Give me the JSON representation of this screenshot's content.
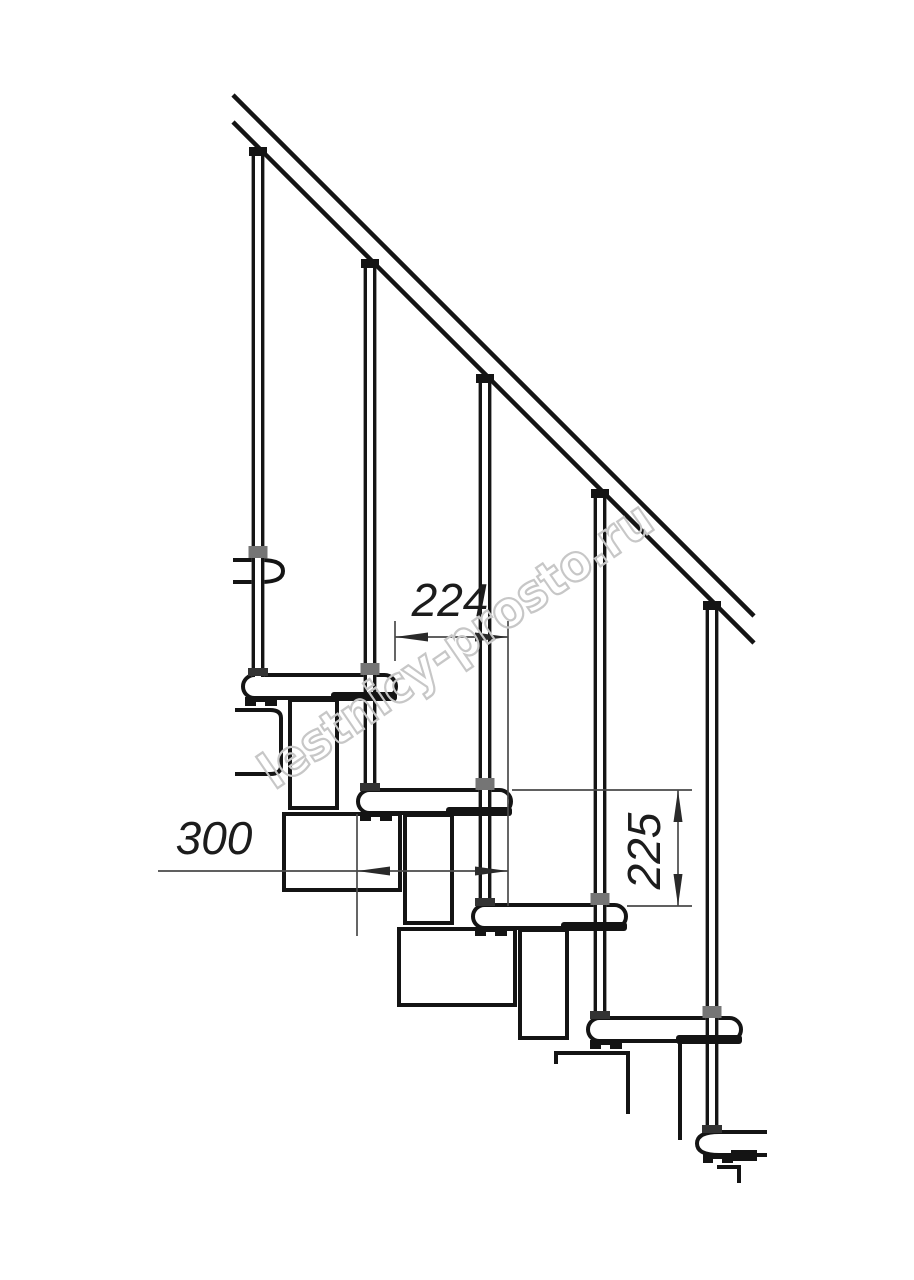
{
  "dimensions": {
    "run": {
      "value": "224"
    },
    "depth": {
      "value": "300"
    },
    "rise": {
      "value": "225"
    }
  },
  "watermark": {
    "text": "lestnicy-prosto.ru"
  },
  "colors": {
    "line": "#141414",
    "dimension": "#4a4a4a",
    "dimension_arrow": "#2a2a2a",
    "dimension_text": "#1c1c1c",
    "watermark": "#c7c7c7",
    "collar_gray": "#757575",
    "collar_dark": "#333333",
    "background": "#ffffff"
  }
}
